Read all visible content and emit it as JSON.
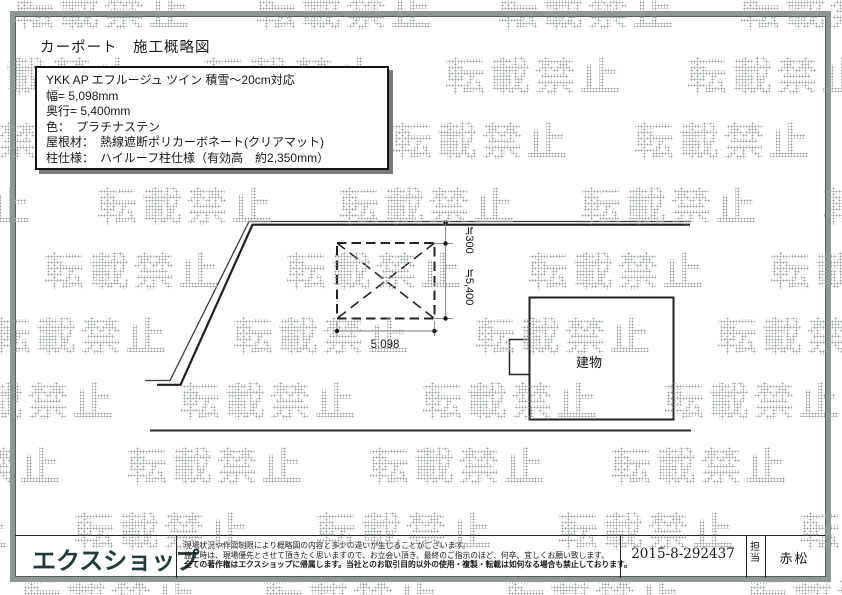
{
  "watermark": {
    "text": "転載禁止",
    "dot_color": "#9aa0a0"
  },
  "title": "カーポート　施工概略図",
  "spec_box": {
    "lines": [
      "YKK AP エフルージュ ツイン 積雪～20cm対応",
      "幅= 5,098mm",
      "奥行= 5,400mm",
      "色：　プラチナステン",
      "屋根材：　熱線遮断ポリカーボネート(クリアマット)",
      "柱仕様：　ハイルーフ柱仕様（有効高　約2,350mm）"
    ]
  },
  "diagram": {
    "width_dim": "5,098",
    "offset_dim": "≒300",
    "depth_dim": "≒5,400",
    "building_label": "建物"
  },
  "footer": {
    "logo": "エクスショップ",
    "logo_color": "#233a3c",
    "disclaimer": [
      "現場状況や作図制限により概略図の内容と多少の違いが生じることがございます。",
      "施工時は、現場優先とさせて頂きたく思いますので、お立会い頂き、最終のご指示のほど、何卒、宜しくお願い致します。",
      "全ての著作権はエクスショップに帰属します。当社とのお取引目的以外の使用・複製・転載は如何なる場合も禁止しております。"
    ],
    "order_number": "2015-8-292437",
    "staff_label": "担当",
    "staff_name": "赤松"
  }
}
